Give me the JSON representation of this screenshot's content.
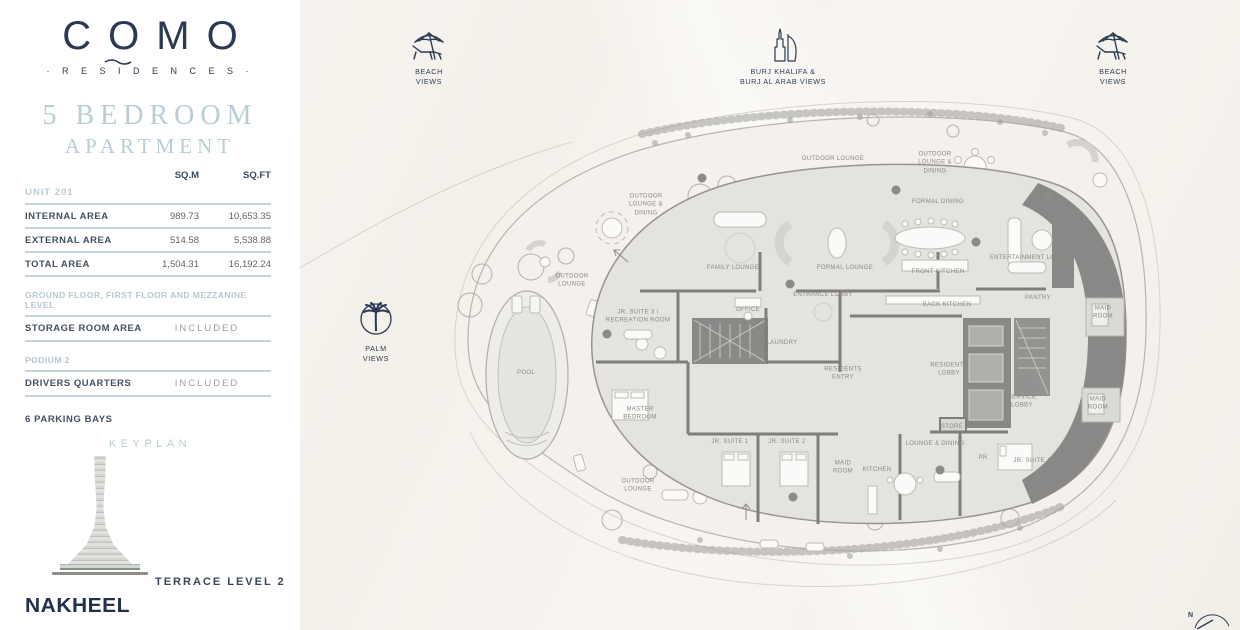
{
  "brand": {
    "name": "COMO",
    "tagline": "· R E S I D E N C E S ·"
  },
  "listing": {
    "title": "5 BEDROOM",
    "subtitle": "APARTMENT"
  },
  "area_table": {
    "headers": {
      "sqm": "SQ.M",
      "sqft": "SQ.FT"
    },
    "unit": "UNIT 201",
    "rows": [
      {
        "label": "INTERNAL AREA",
        "sqm": "989.73",
        "sqft": "10,653.35"
      },
      {
        "label": "EXTERNAL AREA",
        "sqm": "514.58",
        "sqft": "5,538.88"
      },
      {
        "label": "TOTAL AREA",
        "sqm": "1,504.31",
        "sqft": "16,192.24"
      }
    ],
    "storage": {
      "header": "GROUND FLOOR, FIRST FLOOR AND MEZZANINE LEVEL",
      "label": "STORAGE ROOM AREA",
      "value": "INCLUDED"
    },
    "podium": {
      "header": "PODIUM 2",
      "label": "DRIVERS QUARTERS",
      "value": "INCLUDED"
    },
    "note": "6 PARKING BAYS"
  },
  "keyplan": {
    "title": "KEYPLAN",
    "caption": "TERRACE LEVEL 2"
  },
  "footer": {
    "developer": "NAKHEEL"
  },
  "view_markers": {
    "beach_left": {
      "label": [
        "BEACH",
        "VIEWS"
      ]
    },
    "burj": {
      "label": [
        "BURJ KHALIFA &",
        "BURJ AL ARAB VIEWS"
      ]
    },
    "beach_right": {
      "label": [
        "BEACH",
        "VIEWS"
      ]
    },
    "palm": {
      "label": [
        "PALM",
        "VIEWS"
      ]
    }
  },
  "floorplan": {
    "compass": "N",
    "room_labels": [
      {
        "text": [
          "OUTDOOR",
          "LOUNGE &",
          "DINING"
        ],
        "x": 646,
        "y": 205
      },
      {
        "text": [
          "OUTDOOR LOUNGE"
        ],
        "x": 833,
        "y": 159
      },
      {
        "text": [
          "OUTDOOR",
          "LOUNGE &",
          "DINING"
        ],
        "x": 935,
        "y": 163
      },
      {
        "text": [
          "OUTDOOR",
          "LOUNGE"
        ],
        "x": 572,
        "y": 281
      },
      {
        "text": [
          "POOL"
        ],
        "x": 526,
        "y": 373
      },
      {
        "text": [
          "OUTDOOR",
          "LOUNGE"
        ],
        "x": 638,
        "y": 486
      },
      {
        "text": [
          "FAMILY LOUNGE"
        ],
        "x": 733,
        "y": 268
      },
      {
        "text": [
          "FORMAL DINING"
        ],
        "x": 938,
        "y": 202
      },
      {
        "text": [
          "FORMAL LOUNGE"
        ],
        "x": 845,
        "y": 268
      },
      {
        "text": [
          "FRONT KITCHEN"
        ],
        "x": 938,
        "y": 272
      },
      {
        "text": [
          "ENTERTAINMENT LOUNGE"
        ],
        "x": 1032,
        "y": 258
      },
      {
        "text": [
          "ENTRANCE LOBBY"
        ],
        "x": 823,
        "y": 295
      },
      {
        "text": [
          "BACK KITCHEN"
        ],
        "x": 947,
        "y": 305
      },
      {
        "text": [
          "PANTRY"
        ],
        "x": 1038,
        "y": 298
      },
      {
        "text": [
          "OFFICE"
        ],
        "x": 748,
        "y": 310
      },
      {
        "text": [
          "JR. SUITE 3 /",
          "RECREATION ROOM"
        ],
        "x": 638,
        "y": 317
      },
      {
        "text": [
          "LAUNDRY"
        ],
        "x": 782,
        "y": 343
      },
      {
        "text": [
          "MAID",
          "ROOM"
        ],
        "x": 1103,
        "y": 313
      },
      {
        "text": [
          "RESIDENTS",
          "ENTRY"
        ],
        "x": 843,
        "y": 374
      },
      {
        "text": [
          "RESIDENTS",
          "LOBBY"
        ],
        "x": 949,
        "y": 370
      },
      {
        "text": [
          "SERVICE",
          "LOBBY"
        ],
        "x": 1022,
        "y": 402
      },
      {
        "text": [
          "MAID",
          "ROOM"
        ],
        "x": 1098,
        "y": 404
      },
      {
        "text": [
          "MASTER",
          "BEDROOM"
        ],
        "x": 640,
        "y": 414
      },
      {
        "text": [
          "STORE"
        ],
        "x": 952,
        "y": 427
      },
      {
        "text": [
          "LOUNGE & DINING"
        ],
        "x": 935,
        "y": 444
      },
      {
        "text": [
          "JR. SUITE 1"
        ],
        "x": 730,
        "y": 442
      },
      {
        "text": [
          "JR. SUITE 2"
        ],
        "x": 787,
        "y": 442
      },
      {
        "text": [
          "JR. SUITE 4"
        ],
        "x": 1032,
        "y": 461
      },
      {
        "text": [
          "MAID",
          "ROOM"
        ],
        "x": 843,
        "y": 468
      },
      {
        "text": [
          "KITCHEN"
        ],
        "x": 877,
        "y": 470
      },
      {
        "text": [
          "PR"
        ],
        "x": 983,
        "y": 458
      }
    ]
  },
  "colors": {
    "navy": "#2b3a52",
    "teal": "#b9ced4",
    "plan_fill": "#e5e3e0",
    "plan_dark": "#8a8886"
  }
}
